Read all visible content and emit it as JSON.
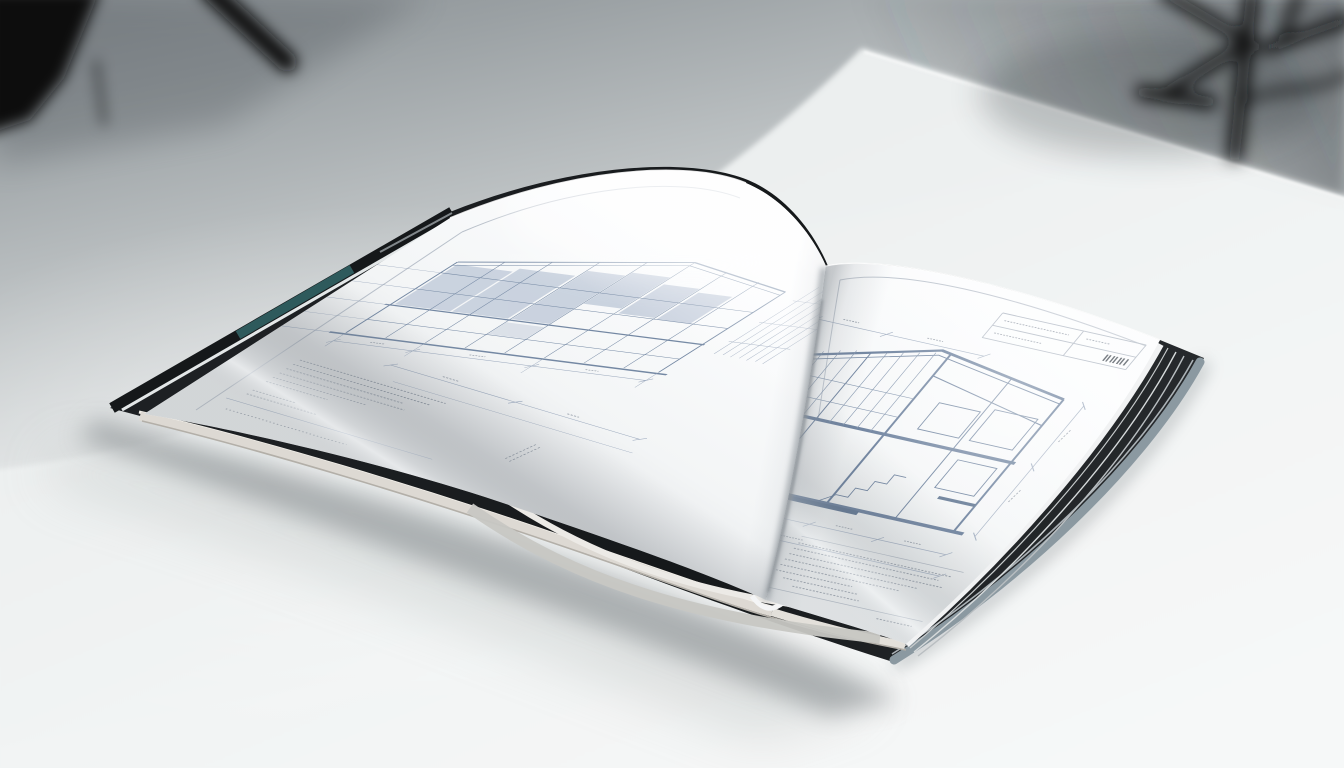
{
  "scene": {
    "setting": "photo-studio tabletop",
    "objects": [
      "open hardcover blueprint book",
      "white table surface",
      "blurred tripod silhouette left",
      "blurred tripod silhouette right"
    ]
  },
  "book": {
    "cover": "dark hardcover with teal spine accent and slate fore-edge",
    "left_page": "building elevation drawing with shaded glazing panels, extension lines, dimension chain and specification note rows",
    "right_page": "building section drawing with dimension chains, vertical dimension chain, title block with barcode mark and notes block"
  },
  "colors": {
    "backdrop_dark": "#343b40",
    "table": "#eef1f1",
    "table_bright": "#f7f9f9",
    "cover_black": "#15181a",
    "cover_teal": "#2e5a5c",
    "cover_slate": "#8b99a1",
    "cover_highlight": "#eef2f3",
    "page_white": "#fcfdfe",
    "page_curl": "#cdd0d2",
    "page_edge_cream": "#ddd9d3",
    "page_edge_dark": "#b3afa8",
    "blueprint_light": "#98a6bb",
    "blueprint_medium": "#7488a3",
    "blueprint_dark": "#5a7191",
    "blueprint_fill": "#bac5d6",
    "micro_text": "#8c95a1",
    "frame_line": "#a9b2be",
    "barcode": "#3c444c",
    "shadow": "#6f7679",
    "tripod": "#0b0d0f"
  }
}
